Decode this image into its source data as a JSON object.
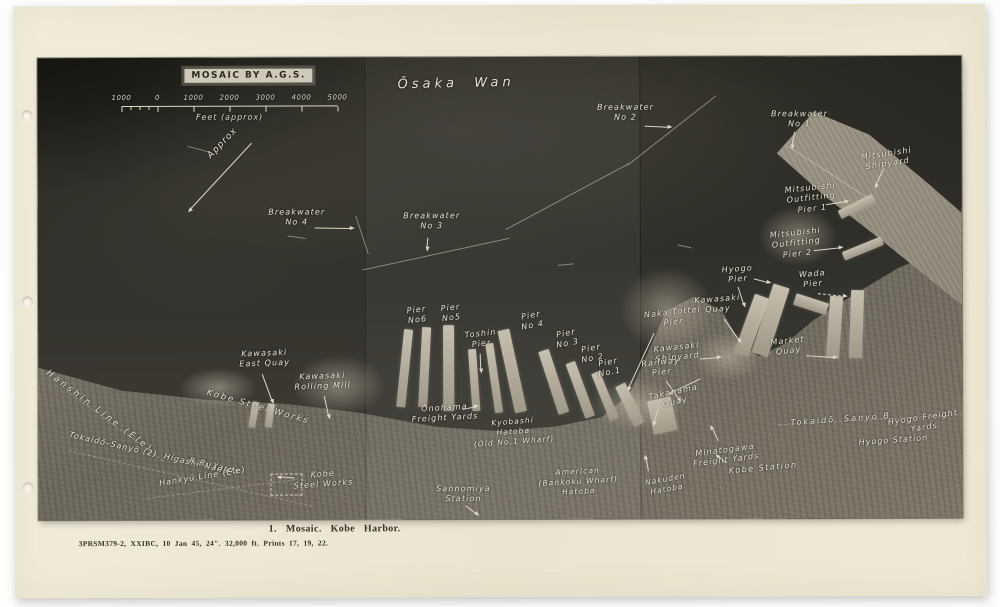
{
  "photo": {
    "stamp": "MOSAIC BY A.G.S.",
    "scale": {
      "ticks": [
        "1000",
        "0",
        "1000",
        "2000",
        "3000",
        "4000",
        "5000"
      ],
      "unit_label": "Feet (approx)"
    },
    "labels": [
      {
        "t": "Ōsaka  Wan",
        "x": 360,
        "y": 20,
        "r": -1,
        "s": 13,
        "ls": 4
      },
      {
        "t": "Breakwater\nNo 2",
        "x": 588,
        "y": 46,
        "c": 1
      },
      {
        "t": "Breakwater\nNo 1",
        "x": 762,
        "y": 53,
        "c": 1
      },
      {
        "t": "Breakwater\nNo 4",
        "x": 259,
        "y": 150,
        "c": 1
      },
      {
        "t": "Breakwater\nNo 3",
        "x": 394,
        "y": 154,
        "c": 1
      },
      {
        "t": "Approx",
        "x": 168,
        "y": 96,
        "r": -46,
        "s": 9
      },
      {
        "t": "Mitsubishi\nShipyard",
        "x": 848,
        "y": 93,
        "c": 1,
        "r": -8
      },
      {
        "t": "Mitsubishi\nOutfitting\nPier 1",
        "x": 772,
        "y": 127,
        "c": 1,
        "r": -6
      },
      {
        "t": "Mitsubishi\nOutfitting\nPier 2",
        "x": 757,
        "y": 172,
        "c": 1,
        "r": -6
      },
      {
        "t": "Hyogo\nPier",
        "x": 699,
        "y": 208,
        "c": 1,
        "r": -4
      },
      {
        "t": "Wada\nPier",
        "x": 774,
        "y": 213,
        "c": 1,
        "r": -4
      },
      {
        "t": "Kawasaki\nQuay",
        "x": 679,
        "y": 238,
        "c": 1,
        "r": -4
      },
      {
        "t": "Market\nQuay",
        "x": 749,
        "y": 280,
        "c": 1,
        "r": -6
      },
      {
        "t": "Kawasaki\nShipyard",
        "x": 638,
        "y": 286,
        "c": 1,
        "r": -6
      },
      {
        "t": "Railway\nPier",
        "x": 622,
        "y": 301,
        "c": 1,
        "r": -6
      },
      {
        "t": "Naka Tottei\nPier",
        "x": 634,
        "y": 251,
        "c": 1,
        "r": -6
      },
      {
        "t": "Pier\nNo6",
        "x": 378,
        "y": 248,
        "c": 1,
        "r": -6
      },
      {
        "t": "Pier\nNo5",
        "x": 412,
        "y": 246,
        "c": 1,
        "r": -6
      },
      {
        "t": "Toshin\nPier",
        "x": 442,
        "y": 272,
        "c": 1,
        "r": -6
      },
      {
        "t": "Pier\nNo 4",
        "x": 492,
        "y": 254,
        "c": 1,
        "r": -10
      },
      {
        "t": "Pier\nNo 3",
        "x": 527,
        "y": 272,
        "c": 1,
        "r": -10
      },
      {
        "t": "Pier\nNo 2",
        "x": 552,
        "y": 287,
        "c": 1,
        "r": -10
      },
      {
        "t": "Pier\nNo.1",
        "x": 569,
        "y": 301,
        "c": 1,
        "r": -10
      },
      {
        "t": "Kawasaki\nEast Quay",
        "x": 226,
        "y": 291,
        "c": 1,
        "r": -2
      },
      {
        "t": "Kawasaki\nRolling Mill",
        "x": 284,
        "y": 314,
        "c": 1,
        "r": -2
      },
      {
        "t": "Kobe Steel Works",
        "x": 170,
        "y": 330,
        "r": 16,
        "s": 8.5,
        "ls": 2
      },
      {
        "t": "Hanshin Line (Ele)",
        "x": 12,
        "y": 310,
        "r": 37,
        "s": 8.5,
        "ls": 3
      },
      {
        "t": "Tokaidō–Sanyō (2)  Higashi–Nada",
        "x": 32,
        "y": 372,
        "r": 13,
        "s": 8,
        "ls": 1
      },
      {
        "t": "R.R. Yards",
        "x": 152,
        "y": 398,
        "r": 13,
        "s": 8
      },
      {
        "t": "Hankyū Line (Ele)",
        "x": 120,
        "y": 421,
        "r": -9,
        "s": 8,
        "ls": 1
      },
      {
        "t": "Kobe\nSteel Works",
        "x": 284,
        "y": 412,
        "c": 1,
        "r": -4
      },
      {
        "t": "Ōnohama\nFreight Yards",
        "x": 406,
        "y": 346,
        "c": 1,
        "r": -3
      },
      {
        "t": "Kyobashi\nHatoba\n(Old No.1 Wharf)",
        "x": 474,
        "y": 360,
        "c": 1,
        "r": -4,
        "s": 7.5
      },
      {
        "t": "American\n(Bankoku Wharf)\nHatoba",
        "x": 539,
        "y": 410,
        "c": 1,
        "r": -3,
        "s": 7.5
      },
      {
        "t": "Sannomiya\nStation",
        "x": 425,
        "y": 427,
        "c": 1
      },
      {
        "t": "Nakuden\nHatoba",
        "x": 626,
        "y": 418,
        "c": 1,
        "r": -10,
        "s": 7.5
      },
      {
        "t": "Minatogawa\nFreight Yards",
        "x": 686,
        "y": 389,
        "c": 1,
        "r": -7
      },
      {
        "t": "Kobe Station",
        "x": 690,
        "y": 410,
        "r": -5,
        "ls": 1.5
      },
      {
        "t": "Takahama\nQuay",
        "x": 634,
        "y": 331,
        "c": 1,
        "r": -12
      },
      {
        "t": "Tokaidō  Sanyo B",
        "x": 752,
        "y": 362,
        "r": -4,
        "ls": 2
      },
      {
        "t": "Hyogo Freight\nYards",
        "x": 884,
        "y": 357,
        "c": 1,
        "r": -8
      },
      {
        "t": "Hyogo Station",
        "x": 820,
        "y": 382,
        "r": -4,
        "ls": 1
      }
    ],
    "arrows": [
      [
        607,
        69,
        26,
        3,
        0
      ],
      [
        757,
        75,
        16,
        100,
        0
      ],
      [
        277,
        170,
        38,
        1,
        0
      ],
      [
        390,
        180,
        12,
        95,
        0
      ],
      [
        214,
        85,
        92,
        133,
        0
      ],
      [
        846,
        112,
        20,
        115,
        0
      ],
      [
        788,
        148,
        22,
        -8,
        0
      ],
      [
        776,
        194,
        28,
        -6,
        0
      ],
      [
        700,
        230,
        20,
        72,
        0
      ],
      [
        716,
        222,
        16,
        15,
        0
      ],
      [
        780,
        237,
        28,
        6,
        1
      ],
      [
        686,
        262,
        28,
        55,
        0
      ],
      [
        768,
        299,
        30,
        4,
        0
      ],
      [
        662,
        302,
        20,
        -4,
        0
      ],
      [
        628,
        324,
        24,
        55,
        0
      ],
      [
        616,
        276,
        62,
        115,
        0
      ],
      [
        442,
        296,
        18,
        88,
        0
      ],
      [
        224,
        316,
        30,
        70,
        0
      ],
      [
        286,
        338,
        22,
        78,
        0
      ],
      [
        424,
        352,
        15,
        -12,
        0
      ],
      [
        427,
        448,
        15,
        38,
        0
      ],
      [
        256,
        420,
        16,
        185,
        0
      ],
      [
        620,
        352,
        16,
        108,
        0
      ],
      [
        662,
        322,
        34,
        155,
        0
      ],
      [
        680,
        384,
        16,
        -115,
        0
      ],
      [
        688,
        406,
        12,
        -140,
        0
      ],
      [
        610,
        414,
        15,
        -100,
        0
      ]
    ],
    "sealines": [
      [
        325,
        212,
        -12,
        150
      ],
      [
        468,
        172,
        -28,
        140
      ],
      [
        590,
        108,
        -38,
        112
      ],
      [
        748,
        88,
        33,
        100
      ],
      [
        318,
        158,
        72,
        40
      ],
      [
        150,
        88,
        15,
        22
      ],
      [
        250,
        178,
        8,
        18
      ],
      [
        520,
        208,
        -5,
        16
      ],
      [
        640,
        188,
        12,
        14
      ]
    ],
    "rails": [
      [
        28,
        332,
        36,
        120
      ],
      [
        30,
        392,
        13,
        250
      ],
      [
        108,
        440,
        -7,
        150
      ],
      [
        740,
        368,
        -3,
        185
      ]
    ],
    "piers": [
      [
        362,
        272,
        9,
        78,
        6
      ],
      [
        382,
        270,
        9,
        80,
        3
      ],
      [
        405,
        268,
        11,
        86,
        0
      ],
      [
        432,
        292,
        8,
        62,
        -4
      ],
      [
        452,
        286,
        8,
        70,
        -8
      ],
      [
        468,
        272,
        12,
        84,
        -12
      ],
      [
        510,
        292,
        11,
        66,
        -18
      ],
      [
        537,
        304,
        10,
        58,
        -20
      ],
      [
        562,
        314,
        9,
        50,
        -22
      ],
      [
        586,
        326,
        11,
        44,
        -26
      ],
      [
        612,
        342,
        24,
        34,
        -12
      ],
      [
        706,
        238,
        15,
        62,
        20
      ],
      [
        724,
        228,
        17,
        72,
        18
      ],
      [
        756,
        242,
        34,
        12,
        18
      ],
      [
        790,
        240,
        13,
        62,
        4
      ],
      [
        812,
        234,
        13,
        68,
        2
      ],
      [
        800,
        146,
        38,
        9,
        -26
      ],
      [
        804,
        188,
        42,
        9,
        -22
      ],
      [
        212,
        344,
        7,
        26,
        10
      ],
      [
        228,
        346,
        7,
        24,
        8
      ]
    ],
    "blobs": [
      [
        300,
        328,
        95,
        62
      ],
      [
        628,
        252,
        95,
        85
      ],
      [
        598,
        348,
        95,
        52
      ],
      [
        180,
        330,
        80,
        40
      ],
      [
        690,
        300,
        70,
        50
      ],
      [
        760,
        180,
        80,
        60
      ]
    ],
    "boxes": [
      [
        232,
        416,
        30,
        20
      ]
    ]
  },
  "caption": {
    "title": "1.  Mosaic.   Kobe Harbor.",
    "detail": "3PRSM379-2,  XXIBC,  10 Jan 45,  24\".  32,000 ft.   Prints 17, 19, 22."
  }
}
